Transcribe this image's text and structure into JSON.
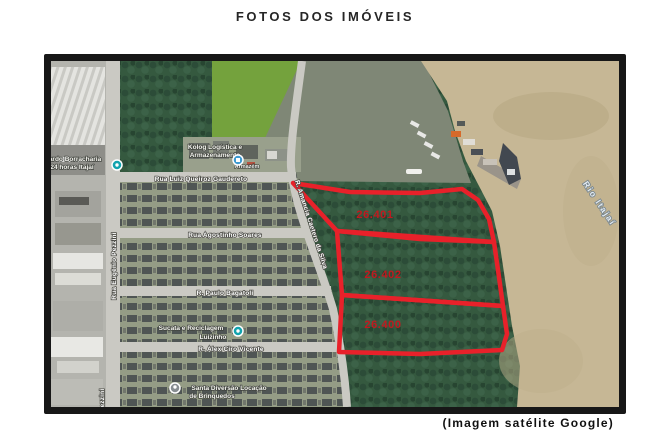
{
  "page": {
    "title": "FOTOS DOS IMÓVEIS",
    "caption": "(Imagem satélite Google)"
  },
  "map": {
    "parcels": [
      {
        "label": "26.401"
      },
      {
        "label": "26.402"
      },
      {
        "label": "26.400"
      }
    ],
    "streets": {
      "gaudereto": "Rua Luiz Queiroz Gaudereto",
      "pezzini": "Rua Eugênio Pezzini",
      "soares": "Rua Agostinho Soares",
      "bagatoli": "R. Paulo Bagatoli",
      "vicente": "R. Alex Ciro Vicente",
      "silva": "R. Amancia Caetero da Silva"
    },
    "places": {
      "borracharia1": "ardo Borracharia",
      "borracharia2": "24 horas Itajaí",
      "kolog1": "Kolog Logística e",
      "kolog2": "Armazenamento",
      "kolog3": "Armazém",
      "sucata1": "Sucata e Reciclagem",
      "sucata2": "Luizinho",
      "santa1": "Santa Diversão Locação",
      "santa2": "de Brinquedos"
    },
    "river_label": "Rio Itajaí",
    "colors": {
      "parcel_outline": "#e8212a",
      "parcel_label": "#c1191f",
      "water": "#c6b795",
      "forest": "#35593f",
      "field": "#74a23d",
      "road": "#cac9c3"
    }
  }
}
